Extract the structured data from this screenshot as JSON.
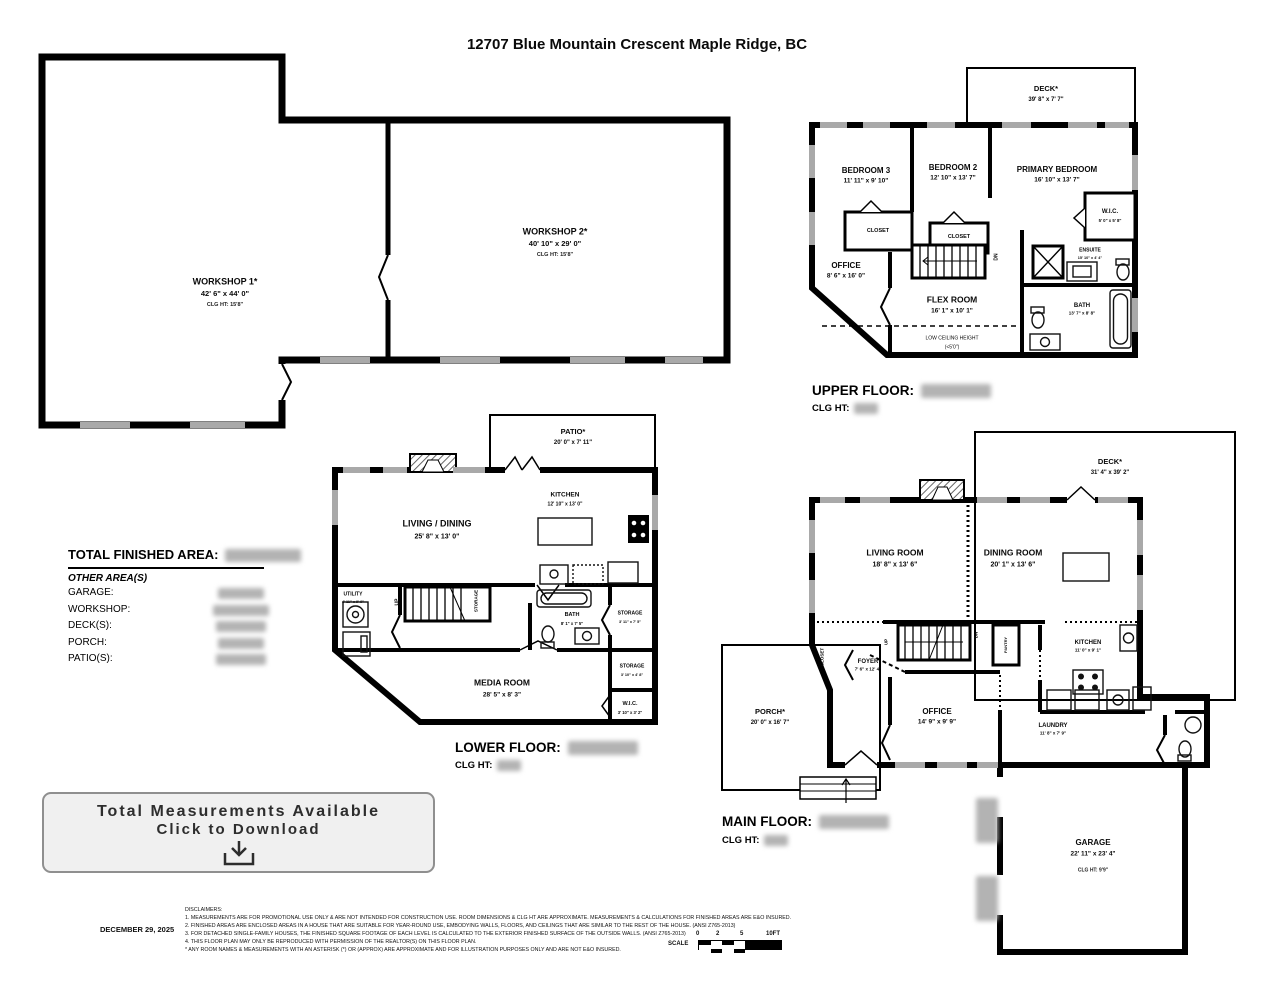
{
  "page": {
    "title": "12707 Blue Mountain Crescent Maple Ridge, BC"
  },
  "workshop_plan": {
    "workshop1_name": "WORKSHOP 1*",
    "workshop1_dims": "42' 6\" x 44' 0\"",
    "workshop1_clg": "CLG HT:  15'8\"",
    "workshop2_name": "WORKSHOP 2*",
    "workshop2_dims": "40' 10\" x 29' 0\"",
    "workshop2_clg": "CLG HT:  15'8\""
  },
  "upper_floor": {
    "heading": "UPPER FLOOR:",
    "clg_heading": "CLG HT:",
    "deck_name": "DECK*",
    "deck_dims": "39' 8\" x 7' 7\"",
    "bedroom3_name": "BEDROOM 3",
    "bedroom3_dims": "11' 11\" x 9' 10\"",
    "bedroom2_name": "BEDROOM 2",
    "bedroom2_dims": "12' 10\" x 13' 7\"",
    "primary_name": "PRIMARY BEDROOM",
    "primary_dims": "16' 10\" x 13' 7\"",
    "wic_name": "W.I.C.",
    "wic_dims": "5' 0\" x 5' 8\"",
    "office_name": "OFFICE",
    "office_dims": "8' 6\" x 16' 0\"",
    "flex_name": "FLEX ROOM",
    "flex_dims": "16' 1\" x 10' 1\"",
    "ensuite_name": "ENSUITE",
    "ensuite_dims": "15' 10\" x 4' 4\"",
    "bath_name": "BATH",
    "bath_dims": "13' 7\" x 8' 8\"",
    "closet1": "CLOSET",
    "closet2": "CLOSET",
    "low_ceiling_1": "LOW CEILING HEIGHT",
    "low_ceiling_2": "(<5'0\")",
    "dn": "DN"
  },
  "lower_floor": {
    "heading": "LOWER FLOOR:",
    "clg_heading": "CLG HT:",
    "patio_name": "PATIO*",
    "patio_dims": "20' 0\" x 7' 11\"",
    "living_name": "LIVING / DINING",
    "living_dims": "25' 8\" x 13' 0\"",
    "kitchen_name": "KITCHEN",
    "kitchen_dims": "12' 10\" x 13' 0\"",
    "utility_name": "UTILITY",
    "utility_dims": "4' 11\" x 9' 9\"",
    "bath_name": "BATH",
    "bath_dims": "8' 1\" x 7' 5\"",
    "storage1_name": "STORAGE",
    "storage1_dims": "3' 11\" x 7' 5\"",
    "storage2_name": "STORAGE",
    "storage2_dims": "3' 10\" x 4' 8\"",
    "media_name": "MEDIA ROOM",
    "media_dims": "28' 5\" x 8' 3\"",
    "wic_name": "W.I.C.",
    "wic_dims": "3' 10\" x 3' 2\"",
    "storage_stairs": "STORAGE",
    "up": "UP"
  },
  "main_floor": {
    "heading": "MAIN FLOOR:",
    "clg_heading": "CLG HT:",
    "deck_name": "DECK*",
    "deck_dims": "31' 4\" x 39' 2\"",
    "living_name": "LIVING ROOM",
    "living_dims": "18' 8\" x 13' 6\"",
    "dining_name": "DINING ROOM",
    "dining_dims": "20' 1\" x 13' 6\"",
    "kitchen_name": "KITCHEN",
    "kitchen_dims": "11' 0\" x 9' 1\"",
    "foyer_name": "FOYER",
    "foyer_dims": "7' 6\" x 12' 4\"",
    "office_name": "OFFICE",
    "office_dims": "14' 9\" x 9' 9\"",
    "laundry_name": "LAUNDRY",
    "laundry_dims": "11' 8\" x 7' 9\"",
    "porch_name": "PORCH*",
    "porch_dims": "20' 0\" x 16' 7\"",
    "garage_name": "GARAGE",
    "garage_dims": "22' 11\" x 23' 4\"",
    "garage_clg": "CLG HT:  9'9\"",
    "closet": "CLOSET",
    "pantry": "PANTRY",
    "up": "UP",
    "dn": "DN"
  },
  "summary": {
    "total_label": "TOTAL FINISHED AREA:",
    "other_label": "OTHER AREA(S)",
    "rows": [
      {
        "label": "GARAGE:"
      },
      {
        "label": "WORKSHOP:"
      },
      {
        "label": "DECK(S):"
      },
      {
        "label": "PORCH:"
      },
      {
        "label": "PATIO(S):"
      }
    ]
  },
  "download": {
    "line1": "Total Measurements Available",
    "line2": "Click to Download"
  },
  "footer": {
    "date": "DECEMBER 29, 2025",
    "disclaimers_title": "DISCLAIMERS:",
    "lines": [
      "1. MEASUREMENTS ARE FOR PROMOTIONAL USE ONLY & ARE NOT INTENDED FOR CONSTRUCTION USE. ROOM DIMENSIONS & CLG HT ARE APPROXIMATE. MEASUREMENTS & CALCULATIONS FOR FINISHED AREAS ARE E&O INSURED.",
      "2. FINISHED AREAS ARE ENCLOSED AREAS IN A HOUSE THAT ARE SUITABLE FOR YEAR-ROUND USE, EMBODYING WALLS, FLOORS, AND CEILINGS THAT ARE SIMILAR TO THE REST OF THE HOUSE. (ANSI Z765-2013)",
      "3. FOR DETACHED SINGLE-FAMILY HOUSES, THE FINISHED SQUARE FOOTAGE OF EACH LEVEL IS CALCULATED TO THE EXTERIOR FINISHED SURFACE OF THE OUTSIDE WALLS. (ANSI Z765-2013)",
      "4. THIS FLOOR PLAN MAY ONLY BE REPRODUCED WITH PERMISSION OF THE REALTOR(S) ON THIS FLOOR PLAN.",
      "* ANY ROOM NAMES & MEASUREMENTS WITH AN ASTERISK (*) OR (APPROX) ARE APPROXIMATE AND FOR ILLUSTRATION PURPOSES ONLY AND ARE NOT E&O INSURED."
    ],
    "scale_label": "SCALE",
    "scale_ticks": [
      "0",
      "2",
      "5",
      "10FT"
    ]
  }
}
